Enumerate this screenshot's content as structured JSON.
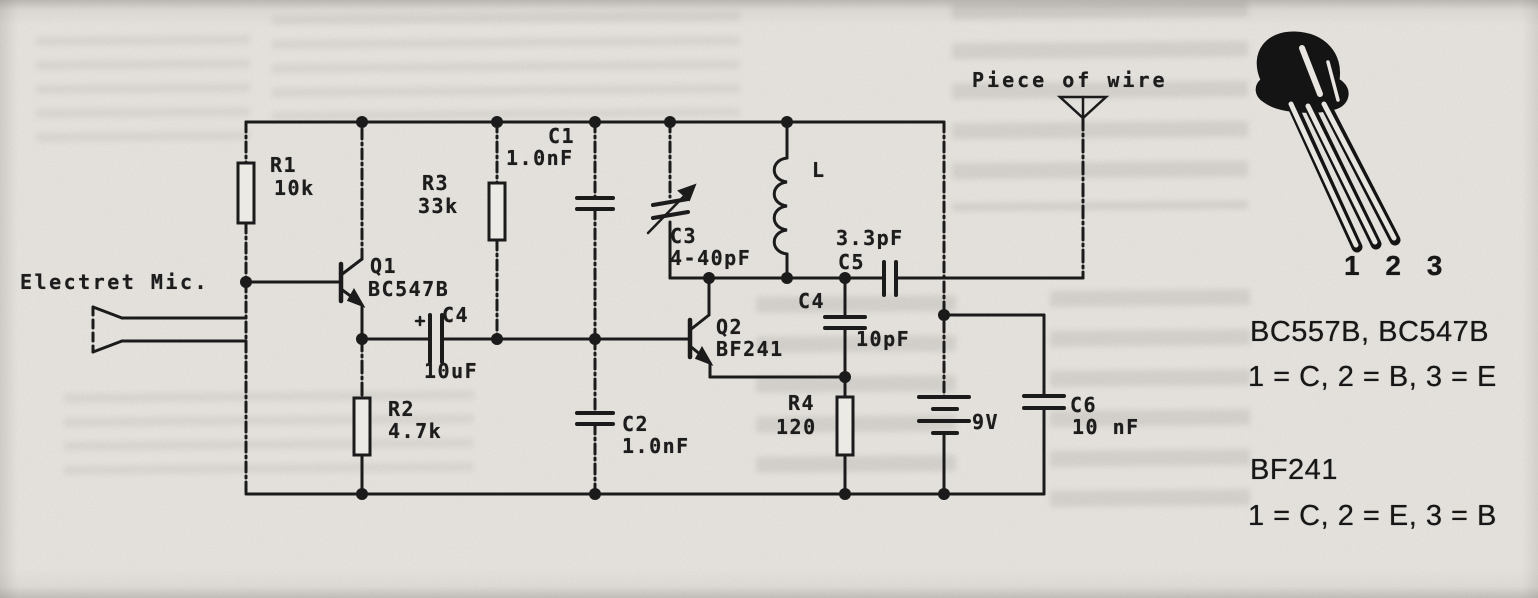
{
  "page": {
    "schematic": {
      "mic_label": "Electret Mic.",
      "antenna_label": "Piece of wire",
      "r1": {
        "ref": "R1",
        "value": "10k"
      },
      "r2": {
        "ref": "R2",
        "value": "4.7k"
      },
      "r3": {
        "ref": "R3",
        "value": "33k"
      },
      "r4": {
        "ref": "R4",
        "value": "120"
      },
      "c1": {
        "ref": "C1",
        "value": "1.0nF"
      },
      "c2": {
        "ref": "C2",
        "value": "1.0nF"
      },
      "c3": {
        "ref": "C3",
        "value": "4-40pF"
      },
      "c4_audio": {
        "ref": "C4",
        "value": "10uF"
      },
      "c4_rf": {
        "ref": "C4",
        "value": "10pF"
      },
      "c5": {
        "ref": "C5",
        "value": "3.3pF"
      },
      "c6": {
        "ref": "C6",
        "value": "10 nF"
      },
      "q1": {
        "ref": "Q1",
        "part": "BC547B"
      },
      "q2": {
        "ref": "Q2",
        "part": "BF241"
      },
      "inductor": {
        "ref": "L"
      },
      "battery": {
        "value": "9V"
      }
    },
    "pinout": {
      "package_pins": "1 2 3",
      "bc_models": "BC557B, BC547B",
      "bc_mapping": "1 = C, 2 = B, 3 = E",
      "bf_model": "BF241",
      "bf_mapping": "1 = C, 2 = E, 3 = B"
    }
  }
}
